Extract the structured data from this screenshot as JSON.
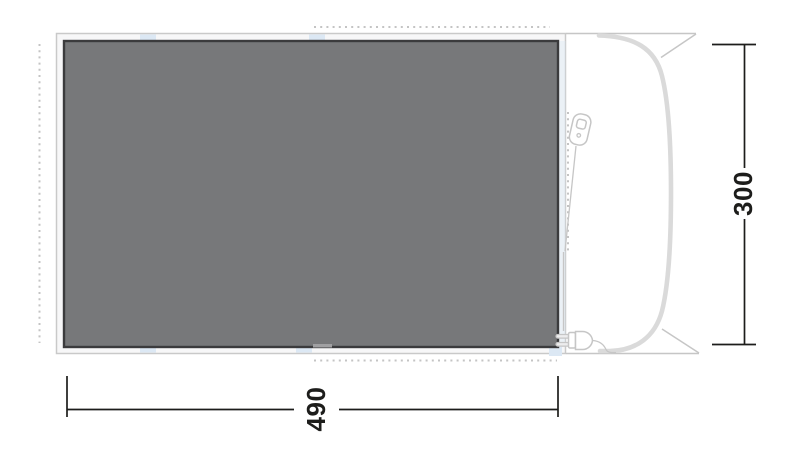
{
  "diagram": {
    "type_label": "tent-footprint-top-view",
    "dimensions": {
      "width_label": "490",
      "height_label": "300"
    },
    "icons": {
      "zipper": "zipper-pull-icon",
      "plug": "power-plug-icon"
    },
    "colors": {
      "bg": "#ffffff",
      "carpet_fill": "#77787a",
      "carpet_border": "#3b3b3d",
      "sheet_fill": "#f7f7f8",
      "sheet_border": "#c9c9c9",
      "fabric_gray": "#dadada",
      "line_gray": "#c6c6c6",
      "dot_gray": "#c4c4c4",
      "tab_blue": "#dce8f4",
      "dim_black": "#1d1d1b"
    }
  }
}
